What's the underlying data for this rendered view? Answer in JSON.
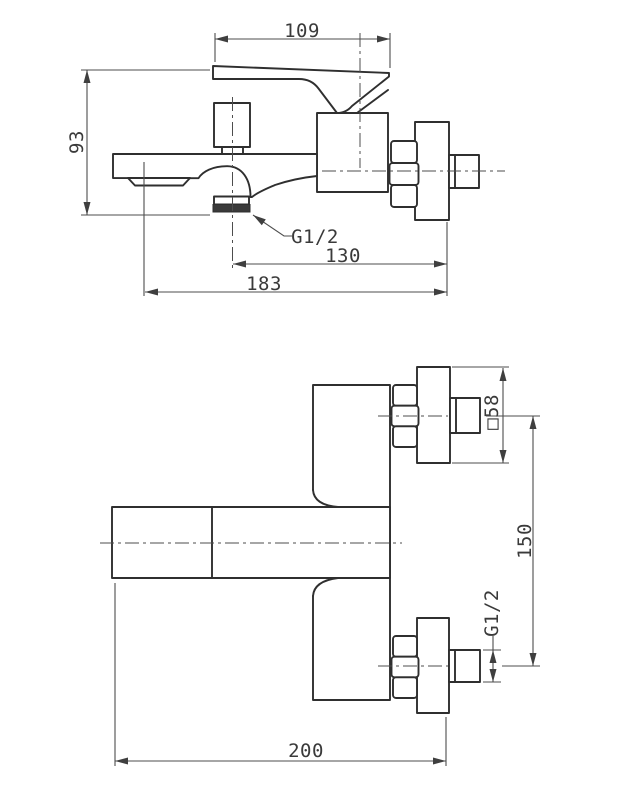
{
  "drawing": {
    "background": "#ffffff",
    "line_color": "#2f2f2f",
    "dim_color": "#4d4d4d",
    "side_view": {
      "handle_length": "109",
      "total_height": "93",
      "shower_outlet_thread": "G1/2",
      "outlet_to_wall": "130",
      "spout_reach": "183"
    },
    "plan_view": {
      "escutcheon_size": "□58",
      "connection_distance": "150",
      "connection_thread": "G1/2",
      "overall_depth": "200"
    }
  }
}
